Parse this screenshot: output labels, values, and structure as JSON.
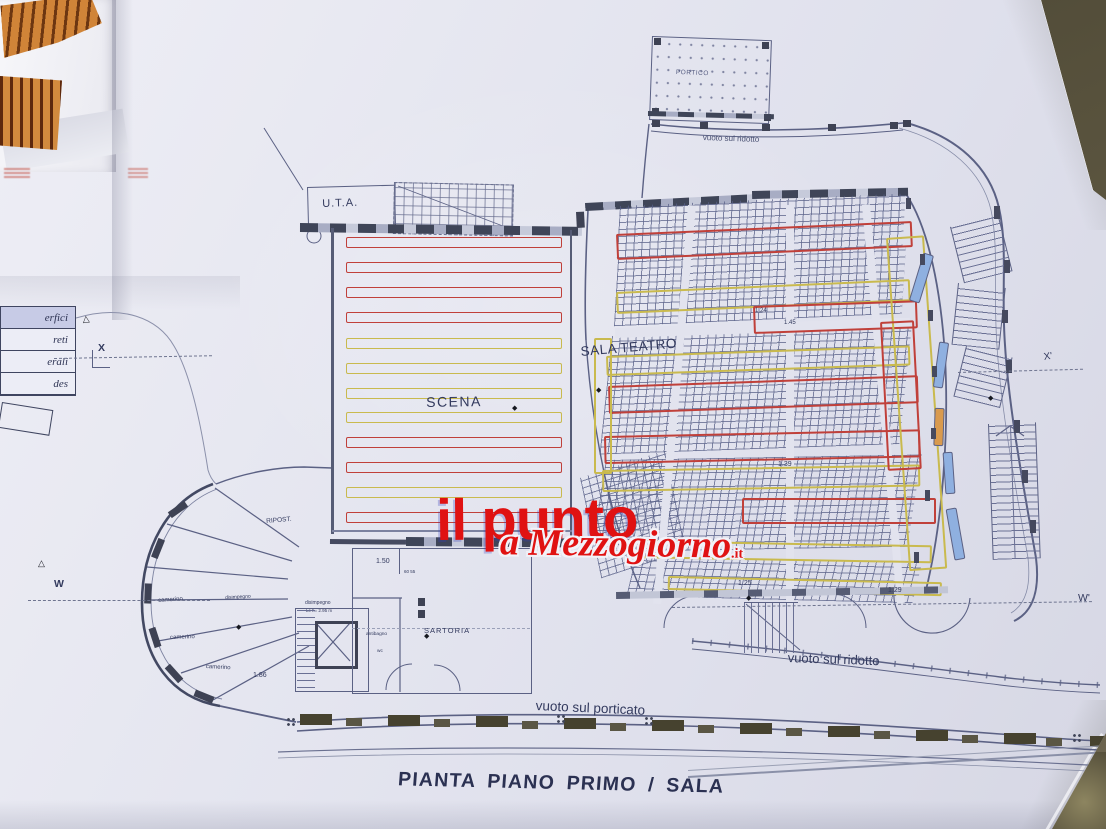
{
  "title": {
    "text": "PIANTA PIANO PRIMO / SALA"
  },
  "watermark": {
    "primary": "il punto",
    "secondary": "a Mezzogiorno",
    "suffix": ".it",
    "color": "#e01212"
  },
  "rooms": {
    "uta": "U.T.A.",
    "scena": "SCENA",
    "sala_teatro": "SALA TEATRO",
    "portico": "PORTICO",
    "sartoria": "SARTORIA",
    "ripostiglio": "RIPOST.",
    "camerino": "camerino",
    "disimpegno": "disimpegno",
    "disimpegno_note": "Lc h= 2.95 m",
    "antibagno": "antibagno",
    "wc": "wc"
  },
  "voids": {
    "ridotto": "vuoto sul ridotto",
    "porticato": "vuoto sul porticato"
  },
  "section_markers": {
    "x": "X",
    "x_prime": "X'",
    "w": "W",
    "w_prime": "W'"
  },
  "dimensions": {
    "v150": "1.50",
    "v186": "1.86",
    "v139": "1.39",
    "v125": "1.25",
    "v129": "1.29",
    "v124": "1.24",
    "v145": "1.45",
    "v6055": "60 55"
  },
  "legend_fragments": [
    "erfici",
    "reti",
    "erali",
    "des"
  ],
  "colors": {
    "paper": "#e3e4ef",
    "ink": "#5b6184",
    "wall_dark": "#40465a",
    "stage_red": "#c0403a",
    "stage_yellow": "#c9ba4e",
    "highlight_blue": "#8fb0e0",
    "highlight_orange": "#d99a4e",
    "watermark_red": "#e01212",
    "table": "#57513c"
  }
}
